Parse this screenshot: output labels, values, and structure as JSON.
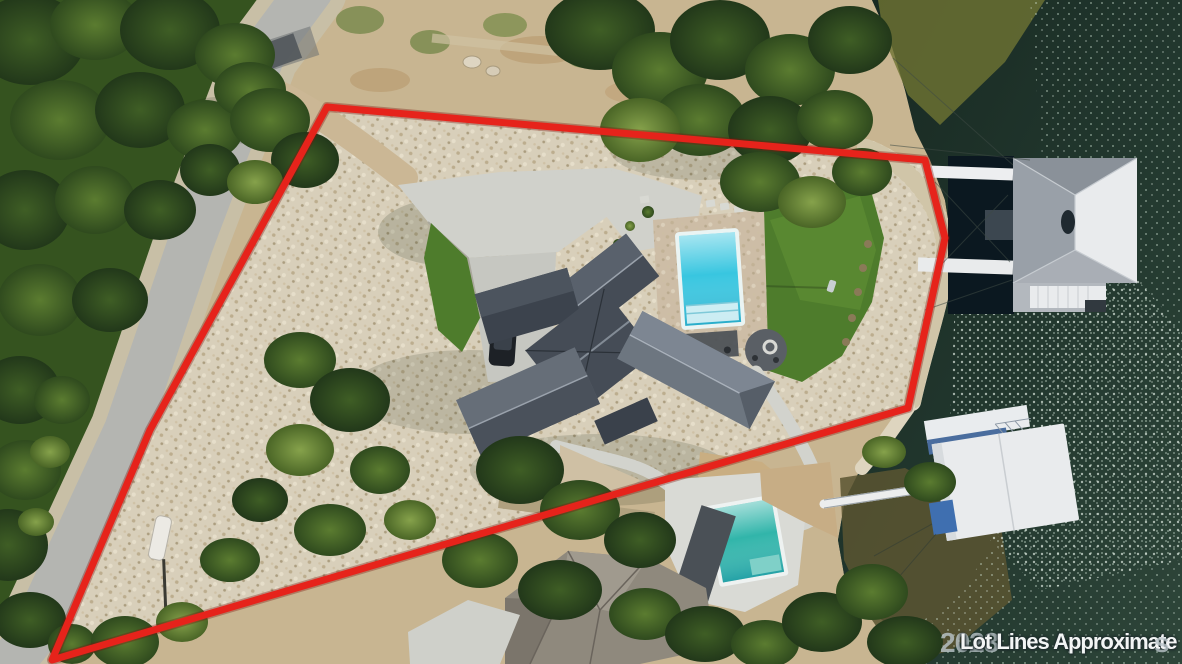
{
  "photo": {
    "kind": "aerial drone photo of lakefront property with outlined lot",
    "watermark": {
      "year": "2023",
      "text": "Lot Lines Approximate",
      "suffix": "s"
    }
  },
  "colors": {
    "lot_line": "#e6231b",
    "water": "#1d312a",
    "water_edge_light": "#3c5a4c",
    "pool_main": "#38c6e0",
    "pool_neighbor": "#31b5aa",
    "lawn": "#4e7c2c",
    "concrete": "#d0d1cb",
    "rock_field": "#d8cfba",
    "road": "#b4b5b1",
    "forest": "#35531f",
    "roof_main_dark": "#454c56",
    "roof_main_light": "#6d7680",
    "roof_neighbor": "#8f897d",
    "dock_roof_gray": "#99a0a8",
    "dock_roof_white": "#e9ebed",
    "dock_deck_blue": "#4a6d9e"
  }
}
